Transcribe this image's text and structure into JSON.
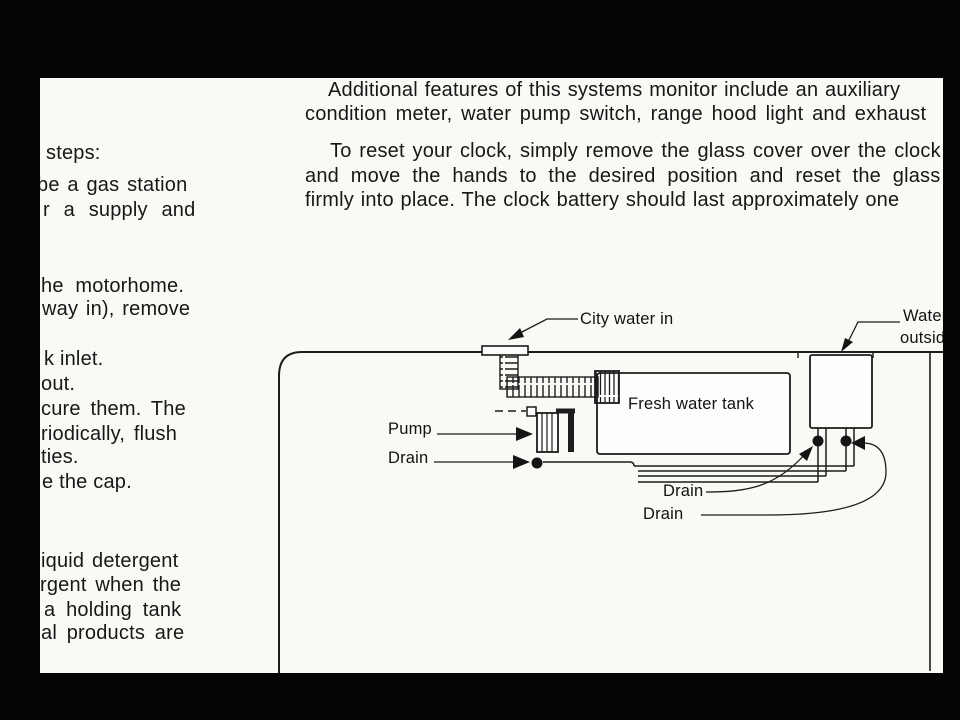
{
  "page": {
    "background": "#050505",
    "paper_color": "#f9f9f6",
    "ink_color": "#171717"
  },
  "left_column": {
    "lines": [
      {
        "name": "left-col-line",
        "text": "steps:",
        "x": 6,
        "y": 64
      },
      {
        "name": "left-col-line",
        "text": "be a gas station",
        "x": -3,
        "y": 96,
        "ws": 2
      },
      {
        "name": "left-col-line",
        "text": "r a supply and",
        "x": 3,
        "y": 121,
        "ws": 8
      },
      {
        "name": "left-col-line",
        "text": "he motorhome.",
        "x": 1,
        "y": 197,
        "ws": 6
      },
      {
        "name": "left-col-line",
        "text": "way in), remove",
        "x": 2,
        "y": 220,
        "ws": 2
      },
      {
        "name": "left-col-line",
        "text": "k inlet.",
        "x": 4,
        "y": 270
      },
      {
        "name": "left-col-line",
        "text": "out.",
        "x": 1,
        "y": 295
      },
      {
        "name": "left-col-line",
        "text": "cure them. The",
        "x": 1,
        "y": 320,
        "ws": 4
      },
      {
        "name": "left-col-line",
        "text": "riodically, flush",
        "x": 1,
        "y": 345,
        "ws": 3
      },
      {
        "name": "left-col-line",
        "text": "ties.",
        "x": 1,
        "y": 368
      },
      {
        "name": "left-col-line",
        "text": "e the cap.",
        "x": 2,
        "y": 393
      },
      {
        "name": "left-col-line",
        "text": "iquid detergent",
        "x": 1,
        "y": 472,
        "ws": 2
      },
      {
        "name": "left-col-line",
        "text": "rgent when the",
        "x": 0,
        "y": 496,
        "ws": 3
      },
      {
        "name": "left-col-line",
        "text": "a holding tank",
        "x": 4,
        "y": 521,
        "ws": 5
      },
      {
        "name": "left-col-line",
        "text": "al products are",
        "x": 1,
        "y": 544,
        "ws": 4
      }
    ]
  },
  "right_column": {
    "lines": [
      {
        "name": "right-col-line",
        "text": "Additional features of this systems monitor include an auxiliary",
        "x": 288,
        "y": 1,
        "ws": 1
      },
      {
        "name": "right-col-line",
        "text": "condition meter, water pump switch, range hood light and exhaust",
        "x": 265,
        "y": 25,
        "ws": 3
      },
      {
        "name": "right-col-line",
        "text": "To reset your clock, simply remove the glass cover over the clock",
        "x": 290,
        "y": 62,
        "ws": 2
      },
      {
        "name": "right-col-line",
        "text": "and move the hands to the desired position and reset the glass",
        "x": 265,
        "y": 87,
        "ws": 6
      },
      {
        "name": "right-col-line",
        "text": "firmly into place. The clock battery should last approximately one",
        "x": 265,
        "y": 111,
        "ws": 1
      }
    ]
  },
  "diagram": {
    "labels": [
      {
        "name": "label-city-water-in",
        "text": "City water in",
        "x": 540,
        "y": 232
      },
      {
        "name": "label-water-outside-line1",
        "text": "Water",
        "x": 863,
        "y": 229
      },
      {
        "name": "label-water-outside-line2",
        "text": "outside",
        "x": 860,
        "y": 251
      },
      {
        "name": "label-fresh-water-tank",
        "text": "Fresh water tank",
        "x": 588,
        "y": 317
      },
      {
        "name": "label-pump",
        "text": "Pump",
        "x": 348,
        "y": 342
      },
      {
        "name": "label-drain-pump",
        "text": "Drain",
        "x": 348,
        "y": 371
      },
      {
        "name": "label-drain-1",
        "text": "Drain",
        "x": 623,
        "y": 404
      },
      {
        "name": "label-drain-2",
        "text": "Drain",
        "x": 603,
        "y": 427
      }
    ]
  }
}
